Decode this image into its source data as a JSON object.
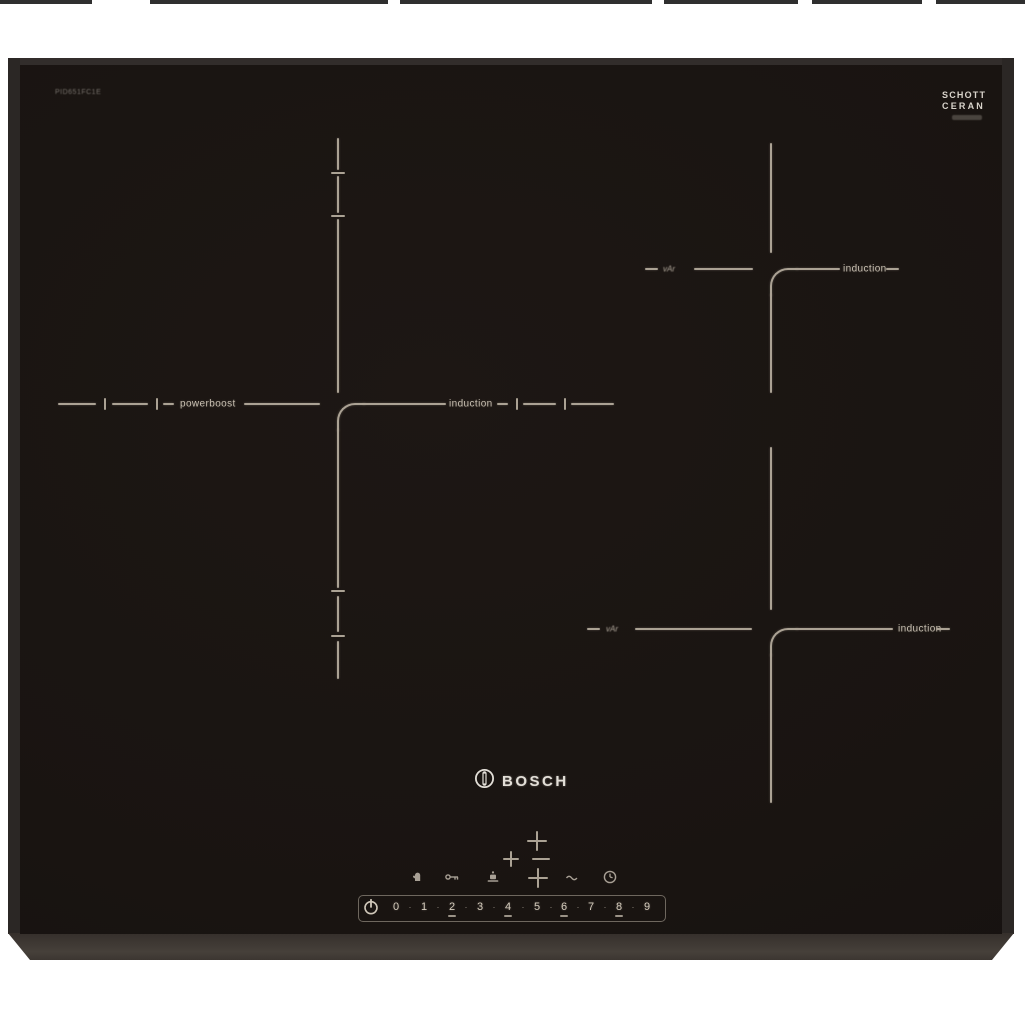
{
  "banner": {
    "note": "cropped dark strip at very top of photo"
  },
  "hob": {
    "model_label": "PID651FC1E",
    "glass_color": "#191411",
    "marking_color": "#aba294",
    "glass_brand": {
      "line1": "SCHOTT",
      "line2": "CERAN"
    },
    "brand": {
      "name": "BOSCH"
    },
    "zones": {
      "left": {
        "label_left": "powerboost",
        "label_right": "induction"
      },
      "top_right": {
        "label_left": "vAr",
        "label_right": "induction"
      },
      "bottom_right": {
        "label_left": "vAr",
        "label_right": "induction"
      }
    },
    "controls": {
      "zone_select": {
        "top": "+",
        "left": "+",
        "center_minus": "",
        "bottom": "+"
      },
      "icons": [
        "hand-icon",
        "key-icon",
        "pan-pause-icon",
        "wave-icon",
        "timer-clock-icon"
      ],
      "power_strip": {
        "power_icon": "power-symbol",
        "digits": [
          "0",
          "1",
          "2",
          "3",
          "4",
          "5",
          "6",
          "7",
          "8",
          "9"
        ],
        "separator": "·"
      }
    }
  }
}
